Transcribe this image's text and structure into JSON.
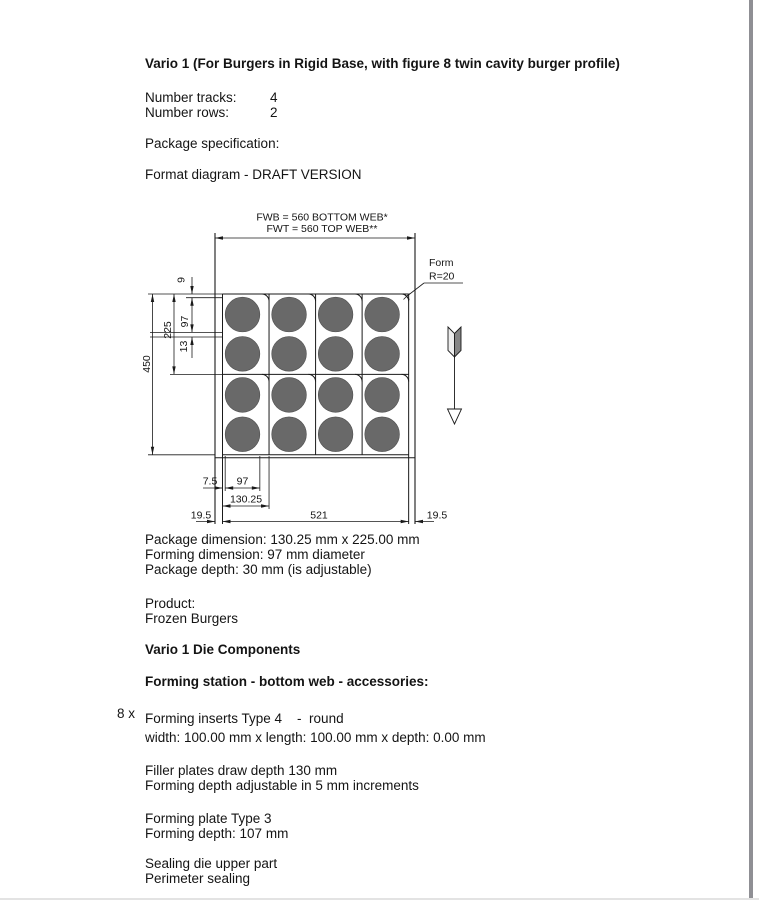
{
  "page": {
    "title": "Vario 1 (For Burgers in Rigid Base, with figure 8 twin cavity burger profile)",
    "spec_rows": [
      {
        "label": "Number tracks:",
        "value": "4"
      },
      {
        "label": "Number rows:",
        "value": "2"
      }
    ],
    "package_specification_label": "Package specification:",
    "format_diagram_label": "Format diagram - DRAFT VERSION"
  },
  "diagram": {
    "fwb_label": "FWB = 560 BOTTOM WEB*",
    "fwt_label": "FWT = 560 TOP WEB**",
    "form_label": "Form",
    "form_radius_label": "R=20",
    "dims": {
      "total_height": "450",
      "package_height": "225",
      "edge_to_cavity": "9",
      "cavity_diameter_vertical": "97",
      "cavity_gap": "13",
      "cavity_left_offset": "7.5",
      "cavity_diameter_horizontal": "97",
      "package_width": "130.25",
      "web_margin_left": "19.5",
      "forming_area_width": "521",
      "web_margin_right": "19.5"
    },
    "grid": {
      "columns": 4,
      "package_rows": 2,
      "cavities_per_package": 2,
      "corner_radius_mm": 20
    },
    "colors": {
      "cavity_fill": "#696969",
      "line": "#1a1a1a"
    }
  },
  "details": {
    "package_dimension": "Package dimension: 130.25 mm x 225.00 mm",
    "forming_dimension": "Forming dimension: 97 mm diameter",
    "package_depth": "Package depth: 30 mm (is adjustable)",
    "product_label": "Product:",
    "product_value": "Frozen Burgers"
  },
  "die_components": {
    "heading": "Vario 1 Die Components",
    "station_heading": "Forming station - bottom web - accessories:",
    "quantity": "8 x",
    "insert_line1": "Forming inserts Type 4    -  round",
    "insert_line2": "width: 100.00 mm x length: 100.00 mm x depth: 0.00 mm",
    "filler_line1": "Filler plates draw depth 130 mm",
    "filler_line2": "Forming depth adjustable in 5 mm increments",
    "plate_line1": "Forming plate Type 3",
    "plate_line2": "Forming depth: 107 mm",
    "sealing_line1": "Sealing die upper part",
    "sealing_line2": "Perimeter sealing"
  }
}
